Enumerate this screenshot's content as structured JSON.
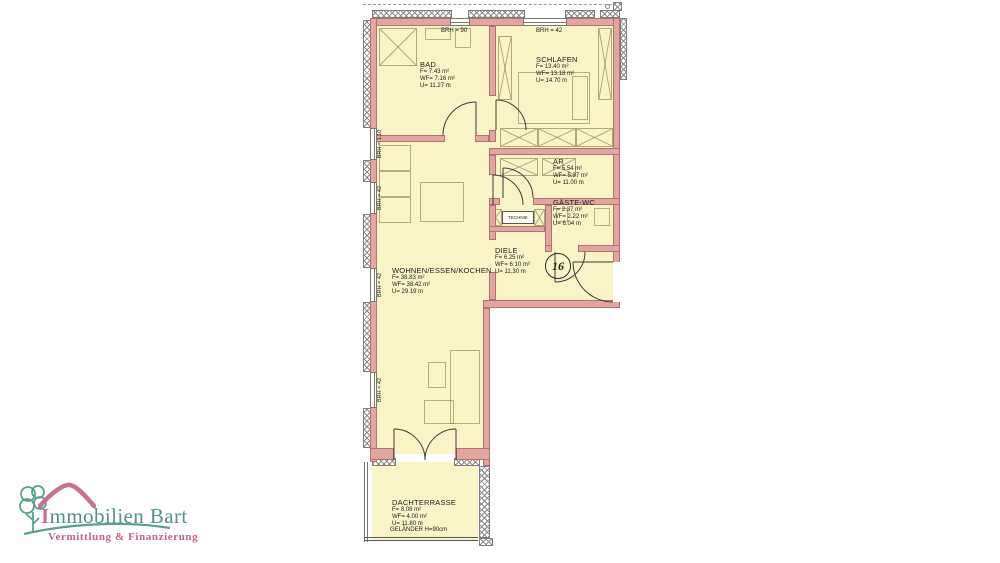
{
  "logo": {
    "brand_initial": "I",
    "brand_rest": "mmobilien Bart",
    "tagline": "Vermittlung & Finanzierung",
    "teal": "#4e9488",
    "pink": "#c96f93"
  },
  "plan": {
    "unit_number": "16",
    "technik_label": "TECHNIK",
    "railing_label": "GELÄNDER H=90cm",
    "colors": {
      "wall": "#e2a5a0",
      "room_fill": "#f8f4c6"
    },
    "brh_top_left": "BRH = 90",
    "brh_top_right": "BRH = 42",
    "brh_left": [
      "BRH = 1.10",
      "BRH = 42",
      "BRH = 42",
      "BRH = 42"
    ],
    "rooms": [
      {
        "name": "BAD",
        "area": "F= 7.43 m²",
        "living_area": "WF= 7.16 m²",
        "perimeter": "U= 11.27 m"
      },
      {
        "name": "SCHLAFEN",
        "area": "F= 13.40 m²",
        "living_area": "WF= 13.18 m²",
        "perimeter": "U= 14.70 m"
      },
      {
        "name": "AR",
        "area": "F= 5.54 m²",
        "living_area": "WF= 5.37 m²",
        "perimeter": "U= 11.00 m"
      },
      {
        "name": "GÄSTE-WC",
        "area": "F= 2.37 m²",
        "living_area": "WF= 2.22 m²",
        "perimeter": "U= 6.04 m"
      },
      {
        "name": "DIELE",
        "area": "F= 6.25 m²",
        "living_area": "WF= 6.10 m²",
        "perimeter": "U= 11.30 m"
      },
      {
        "name": "WOHNEN/ESSEN/KOCHEN",
        "area": "F= 38.83 m²",
        "living_area": "WF= 38.42 m²",
        "perimeter": "U= 29.19 m"
      },
      {
        "name": "DACHTERRASSE",
        "area": "F= 8.08 m²",
        "living_area": "WF= 4.00 m²",
        "perimeter": "U= 11.80 m"
      }
    ]
  }
}
